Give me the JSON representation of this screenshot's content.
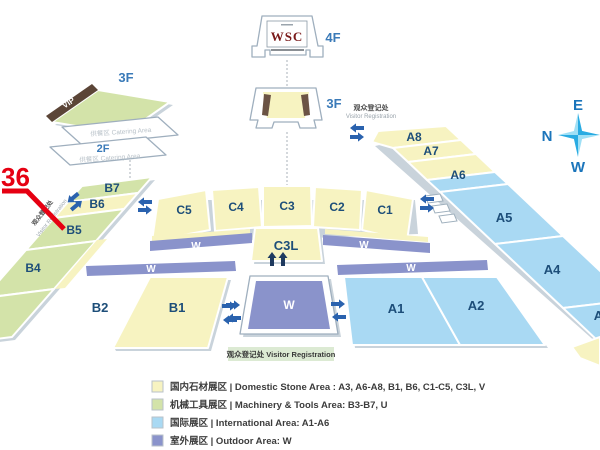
{
  "palette": {
    "domestic": "#f7f3c1",
    "machinery": "#d3e3a9",
    "international": "#a9d9f3",
    "outdoor": "#8a93cb",
    "hall_text": "#1d4e79",
    "floor_text": "#3a7ab8",
    "callout_red": "#e60012",
    "arrow_blue": "#2a62ae",
    "compass_blue": "#1b75bb",
    "vip_brown": "#5b4537"
  },
  "buildings": {
    "wsc": {
      "title": "WSC",
      "floor": "4F"
    },
    "v": {
      "label": "V",
      "floor": "3F"
    },
    "u": {
      "label": "U",
      "floor": "3F",
      "vip": "VIP"
    },
    "catering": {
      "floor": "2F",
      "area": "供餐区 Catering Area"
    }
  },
  "halls": {
    "a1": "A1",
    "a2": "A2",
    "a3": "A3",
    "a4": "A4",
    "a5": "A5",
    "a6": "A6",
    "a7": "A7",
    "a8": "A8",
    "b1": "B1",
    "b2": "B2",
    "b4": "B4",
    "b5": "B5",
    "b6": "B6",
    "b7": "B7",
    "c1": "C1",
    "c2": "C2",
    "c3": "C3",
    "c4": "C4",
    "c5": "C5",
    "c3l": "C3L",
    "w": "W"
  },
  "annotations": {
    "callout": "36",
    "visitor_registration_cn": "观众登记处",
    "visitor_registration_en": "Visitor Registration",
    "visitor_registration_badge": "观众登记处 Visitor Registration"
  },
  "compass": {
    "e": "E",
    "n": "N",
    "w": "W"
  },
  "legend": {
    "items": [
      {
        "color": "#f7f3c1",
        "text": "国内石材展区 | Domestic Stone Area : A3, A6-A8, B1, B6, C1-C5, C3L, V"
      },
      {
        "color": "#d3e3a9",
        "text": "机械工具展区 | Machinery & Tools Area: B3-B7, U"
      },
      {
        "color": "#a9d9f3",
        "text": "国际展区 | International Area:  A1-A6"
      },
      {
        "color": "#8a93cb",
        "text": "室外展区 | Outdoor Area:  W"
      }
    ]
  }
}
